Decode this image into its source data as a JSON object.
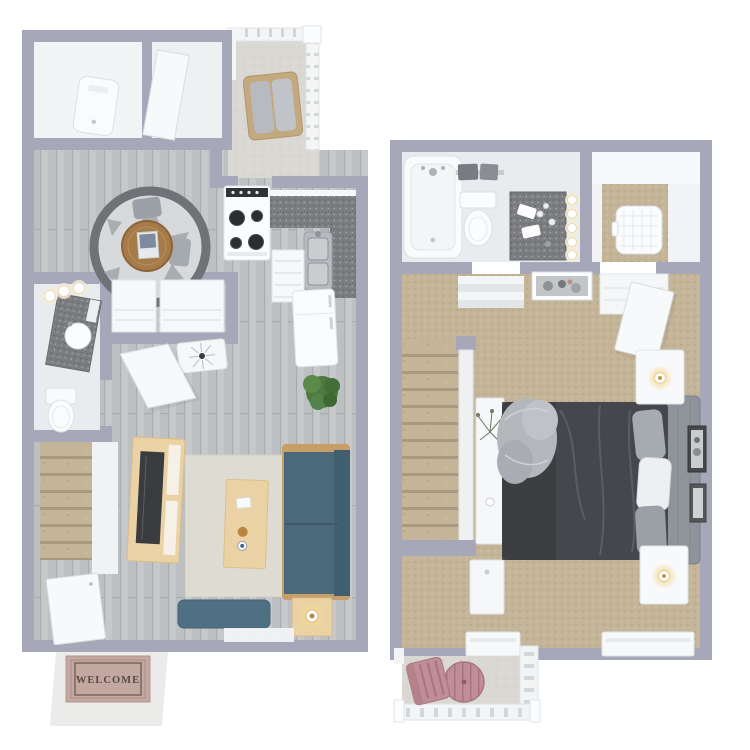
{
  "scene": {
    "type": "two-story townhome 3D floor plan rendering, top-down view",
    "floors_count": 2,
    "background": "#ffffff"
  },
  "palette": {
    "wall": "#a6a8ba",
    "white_room": "#f2f3f5",
    "bath_floor": "#e9ecee",
    "wood_floor": "#c6c8ca",
    "wood_plank": "#b8babc",
    "carpet": "#c4b498",
    "carpet_dark": "#ac9c80",
    "carpet_light": "#d3c7ab",
    "step_shadow": "#a4947a",
    "concrete": "#dad8d3",
    "concrete_dot": "#cbc9c3",
    "counter": "#7c7e82",
    "counter_dark": "#5e6064",
    "counter_light": "#a7a9ac",
    "steel": "#b7babe",
    "sofa": "#4a6a7b",
    "sofa_back": "#41606f",
    "ottoman": "#4f7082",
    "wood_light": "#ead2a4",
    "wood_medium": "#a57c49",
    "rug_ring": "#6f7277",
    "rug_inner": "#d8d9db",
    "rug_beige": "#dedbd3",
    "tv": "#3a3c3f",
    "plant": "#4e7a40",
    "bed_dark": "#45474c",
    "bed_drape": "#3b3d41",
    "headboard": "#8f939a",
    "pillow_gray": "#a6abb1",
    "pillow_light": "#edeff1",
    "mat_pink": "#c3a8a1",
    "mat_border": "#6d5c52",
    "mat_text": "#564a41",
    "stoop": "#ebebe9",
    "balcony_pink": "#c08e96",
    "balcony_pink_dark": "#a8747e",
    "glow": "#ffe9b8"
  },
  "first_floor": {
    "name": "first-floor-plan",
    "rooms": [
      "utility-room",
      "entry-closet",
      "balcony",
      "dining-nook",
      "kitchen",
      "bathroom",
      "hall-closets",
      "staircase",
      "living-room",
      "entry"
    ],
    "furniture": [
      "water-heater",
      "closet-door",
      "wicker-patio-chair",
      "range-stove",
      "kitchen-counter",
      "kitchen-sink",
      "drawer-stack",
      "refrigerator",
      "round-area-rug",
      "dining-table",
      "dining-chairs",
      "vanity-with-sink",
      "vanity-lights",
      "toilet",
      "sunburst-clock-decor",
      "open-interior-door",
      "potted-plant",
      "tv-console",
      "television",
      "beige-area-rug",
      "coffee-table",
      "sofa",
      "ottoman-bench",
      "side-table-with-lamp",
      "front-door"
    ],
    "mat_text": "WELCOME"
  },
  "second_floor": {
    "name": "second-floor-plan",
    "rooms": [
      "bathroom",
      "walk-in-closet",
      "hallway",
      "staircase",
      "bedroom",
      "balcony"
    ],
    "furniture": [
      "bathtub",
      "towel-rack",
      "toilet",
      "bathroom-vanity",
      "vanity-lights",
      "laundry-basket",
      "hall-art-print",
      "closet-shelves",
      "wardrobe-door",
      "console-table",
      "dried-plant",
      "storage-cabinet",
      "bed",
      "fluffy-throw-pillow",
      "bed-pillows",
      "headboard",
      "nightstand-with-lamp-upper",
      "nightstand-with-lamp-lower",
      "wall-art-frames",
      "windows",
      "pink-patio-table",
      "pink-patio-chair"
    ]
  }
}
